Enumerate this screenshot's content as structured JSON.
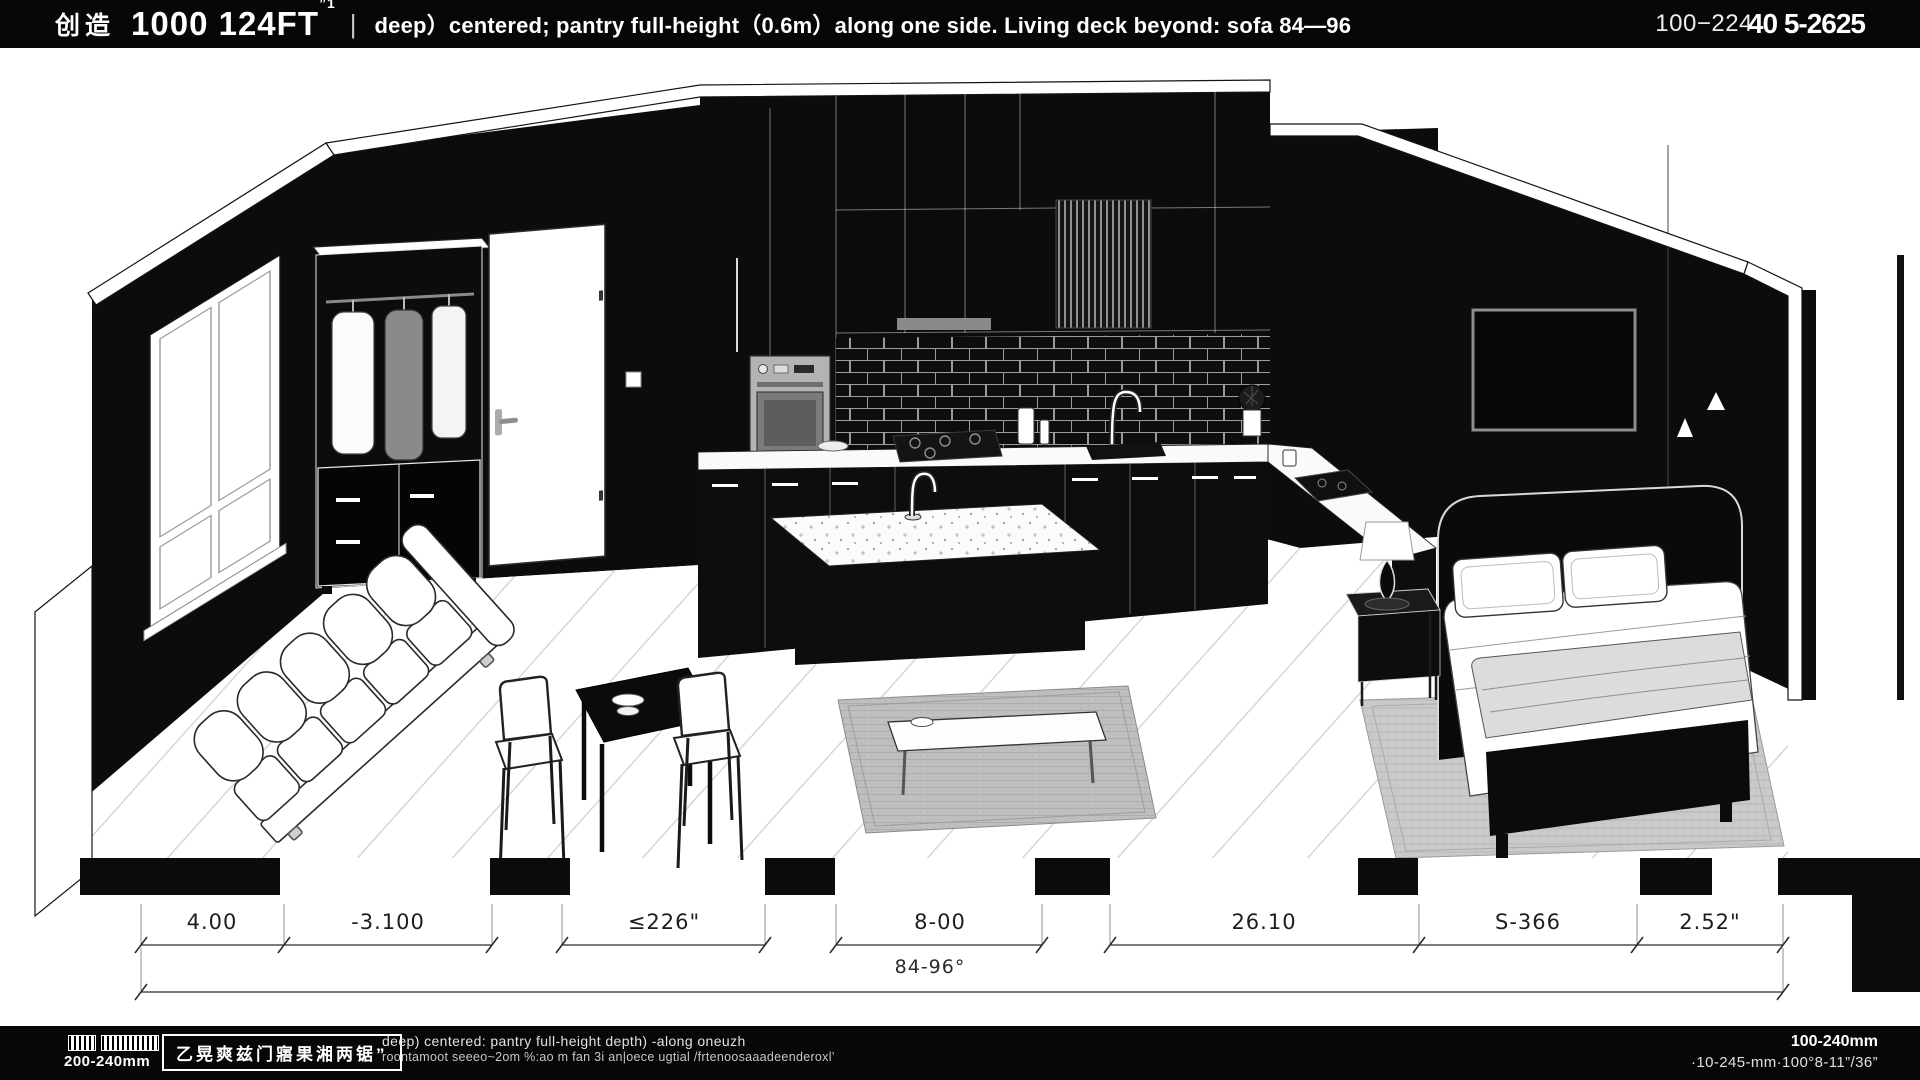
{
  "header": {
    "logo": "创造",
    "title": "1000 124FT",
    "title_sup": "”1",
    "divider": "|",
    "subtitle": "deep）centered; pantry full-height（0.6m）along one side.  Living deck beyond:  sofa 84—96",
    "ref_left": "100−224",
    "ref_right": "40 5-2625"
  },
  "dimensions": {
    "row1": [
      {
        "label": "4.00"
      },
      {
        "label": "-3.100"
      },
      {
        "label": "≤226\""
      },
      {
        "label": "8-00"
      },
      {
        "label": "26.10"
      },
      {
        "label": "S-366"
      },
      {
        "label": "2.52\""
      }
    ],
    "row2": "84-96°"
  },
  "footer": {
    "scale_label": "200-240mm",
    "stamp": "乙晃爽兹门寤果湘两锯”",
    "note_line1": "deep) centered:  pantry full-height   depth) -along oneuzh",
    "note_line2": "roontamoot seeeo~2om %:ao m fan 3i an|oece ugtial  /frtenoosaaadeenderoxl’",
    "right_line1": "100-240mm",
    "right_line2": "·10-245-mm·100°8-11”/36”"
  },
  "scene": {
    "style": "black-and-white isometric cutaway rendering",
    "accent_black": "#0c0c0c",
    "paper_white": "#ffffff",
    "objects": [
      "window",
      "wardrobe",
      "entry-door",
      "light-switch",
      "wall-oven",
      "range-hood",
      "slat-panel",
      "backsplash-tile",
      "countertop",
      "gas-cooktop",
      "kitchen-sink",
      "kitchen-island",
      "island-faucet",
      "sofa",
      "dining-table",
      "dining-chairs",
      "living-rug",
      "coffee-table",
      "bed",
      "pillows",
      "throw-blanket",
      "nightstand",
      "table-lamp",
      "bedroom-rug",
      "framed-art",
      "triangle-sconces"
    ]
  }
}
